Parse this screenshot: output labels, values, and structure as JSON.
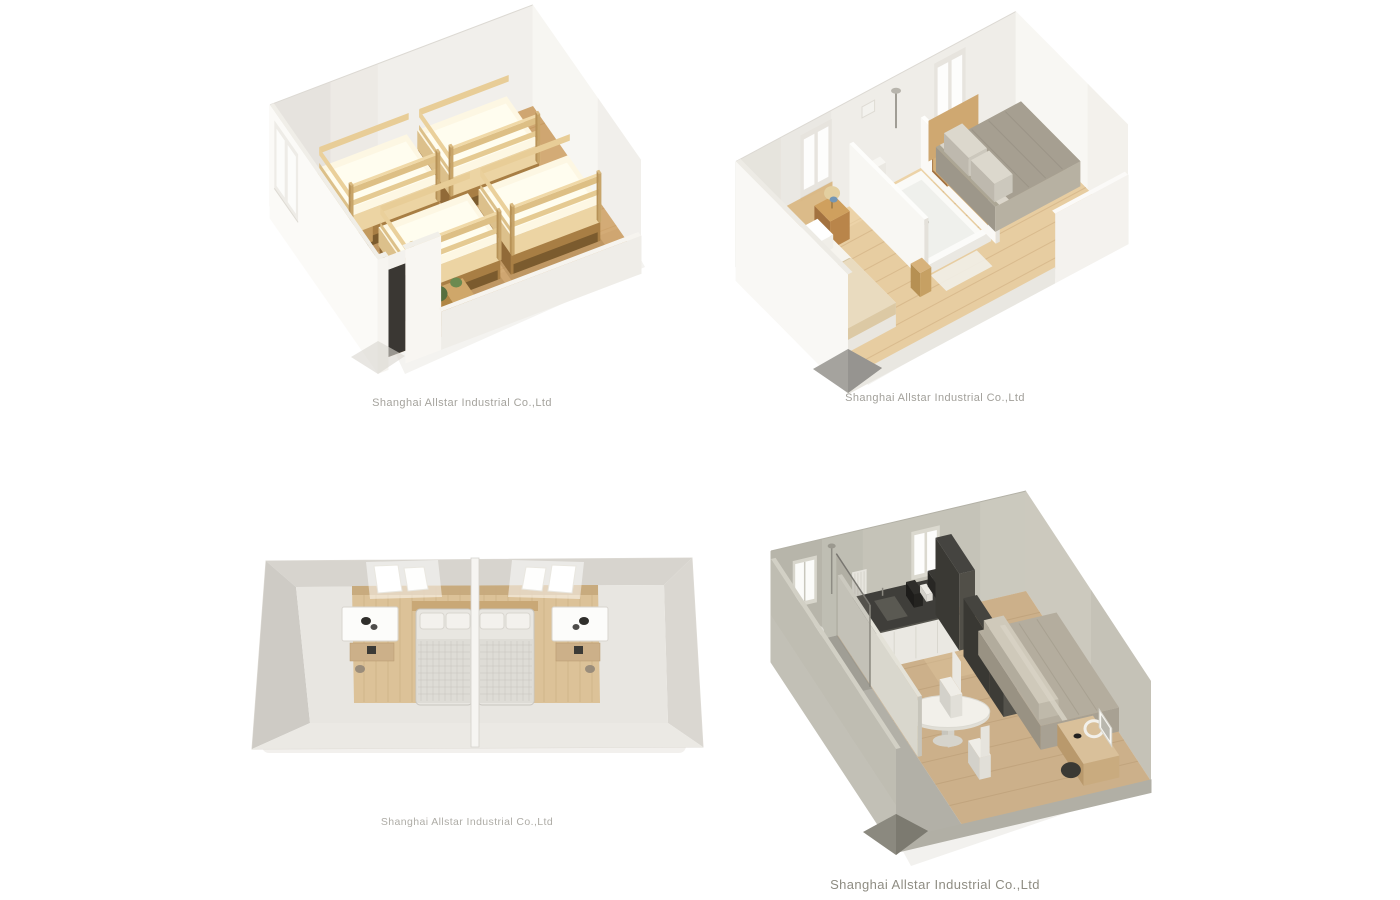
{
  "page": {
    "background": "#ffffff"
  },
  "panels": [
    {
      "name": "bunk-bed-dormitory-render",
      "caption": "Shanghai Allstar Industrial Co.,Ltd"
    },
    {
      "name": "two-bedroom-with-bathroom-render",
      "caption": "Shanghai Allstar Industrial Co.,Ltd"
    },
    {
      "name": "twin-mirrored-bedrooms-top-view",
      "caption": "Shanghai Allstar Industrial Co.,Ltd"
    },
    {
      "name": "studio-kitchen-bathroom-render",
      "caption": "Shanghai Allstar Industrial Co.,Ltd"
    }
  ],
  "palette": {
    "background": "#ffffff",
    "wall_white": "#f1efeb",
    "wall_warm_white": "#efede8",
    "wall_greige": "#c5c3b8",
    "floor_wood": "#cfa671",
    "floor_wood_pale": "#e7cda1",
    "bunk_wood": "#d9b681",
    "mattress_cream": "#fdf7e3",
    "duvet_gray": "#aca695",
    "headboard_wood": "#d6b078",
    "counter_charcoal": "#3f3e3a",
    "watermark_gray": "#a5a39d"
  }
}
